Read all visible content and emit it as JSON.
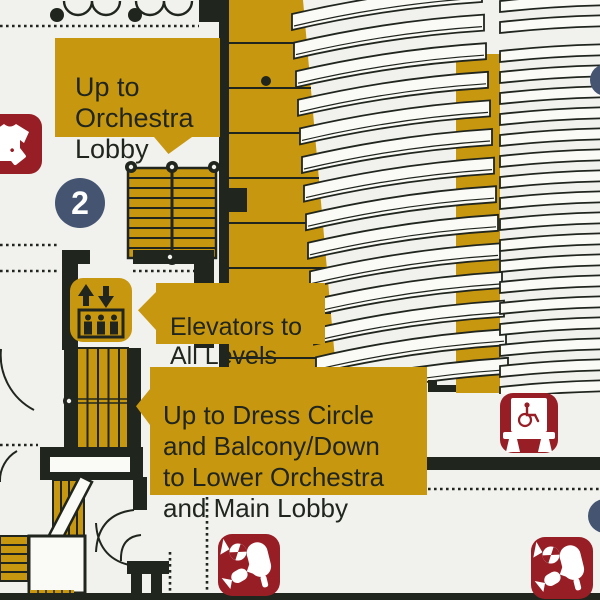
{
  "map": {
    "level_badge": "2",
    "callouts": {
      "orchestra_lobby": "Up to\nOrchestra\nLobby",
      "elevators": "Elevators to\nAll Levels",
      "dress_circle": "Up to Dress Circle\nand Balcony/Down\nto Lower Orchestra\nand Main Lobby"
    },
    "icons": {
      "coat_check": "coat-check-icon",
      "elevator": "elevator-icon",
      "accessible_seating": "accessible-seating-icon",
      "concessions": "concessions-icon"
    },
    "colors": {
      "gold": "#C89710",
      "dark": "#20261E",
      "red": "#981E26",
      "blue": "#445471",
      "background": "#F1F2EE",
      "seat_row": "#FAFAF6"
    }
  }
}
